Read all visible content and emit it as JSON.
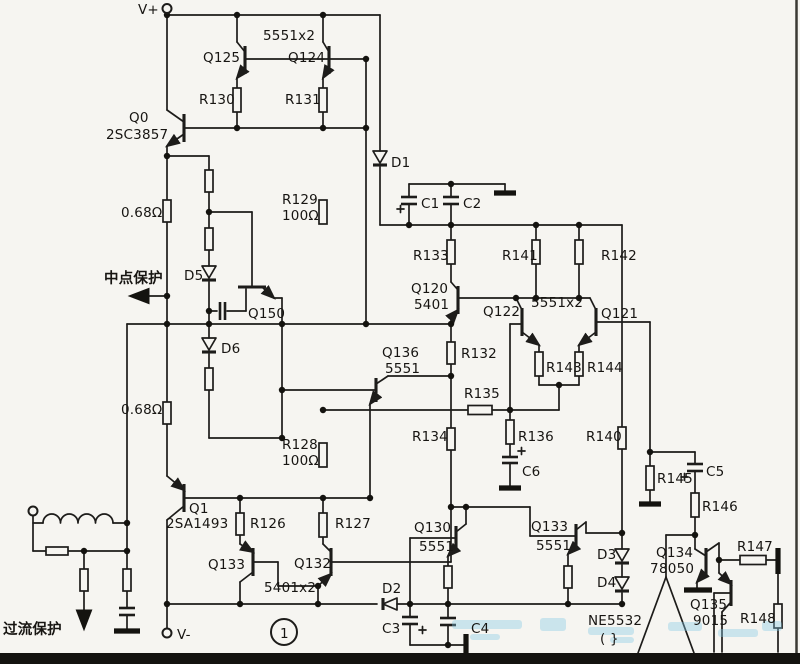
{
  "colors": {
    "ink": "#1d1c1a",
    "paper": "#f6f5f1",
    "watermark": "#84c8e6",
    "border": "#141310"
  },
  "schematic": {
    "power_labels": {
      "vplus": "V+",
      "vminus": "V-"
    },
    "protection": {
      "midpoint": "中点保护",
      "overcurrent": "过流保护"
    },
    "page_marker": "1",
    "opamp": {
      "name": "NE5532",
      "sub": "( }",
      "pin": "7"
    },
    "parts": {
      "q0": "Q0",
      "q0_type": "2SC3857",
      "q1": "Q1",
      "q1_type": "2SA1493",
      "q125": "Q125",
      "q124": "Q124",
      "mirror_type": "5551x2",
      "q150": "Q150",
      "q120": "Q120",
      "q120_type": "5401",
      "q121": "Q121",
      "q122": "Q122",
      "pair_type": "5551x2",
      "q136": "Q136",
      "q136_type": "5551",
      "q130": "Q130",
      "q130_type": "5551",
      "q132": "Q132",
      "q133_left": "Q133",
      "pair2_type": "5401x2",
      "q133_right": "Q133",
      "q133_right_type": "5551",
      "q134": "Q134",
      "q134_type": "8050",
      "q135": "Q135",
      "q135_type": "9015",
      "r126": "R126",
      "r127": "R127",
      "r128": "R128",
      "r128_val": "100Ω",
      "r129": "R129",
      "r129_val": "100Ω",
      "r130": "R130",
      "r131": "R131",
      "r132": "R132",
      "r133": "R133",
      "r134": "R134",
      "r135": "R135",
      "r136": "R136",
      "r140": "R140",
      "r141": "R141",
      "r142": "R142",
      "r143": "R143",
      "r144": "R144",
      "r145": "R145",
      "r146": "R146",
      "r147": "R147",
      "r148": "R148",
      "res068_top": "0.68Ω",
      "res068_bot": "0.68Ω",
      "c1": "C1",
      "c2": "C2",
      "c3": "C3",
      "c4": "C4",
      "c5": "C5",
      "c6": "C6",
      "d1": "D1",
      "d2": "D2",
      "d3": "D3",
      "d4": "D4",
      "d5": "D5",
      "d6": "D6"
    }
  }
}
